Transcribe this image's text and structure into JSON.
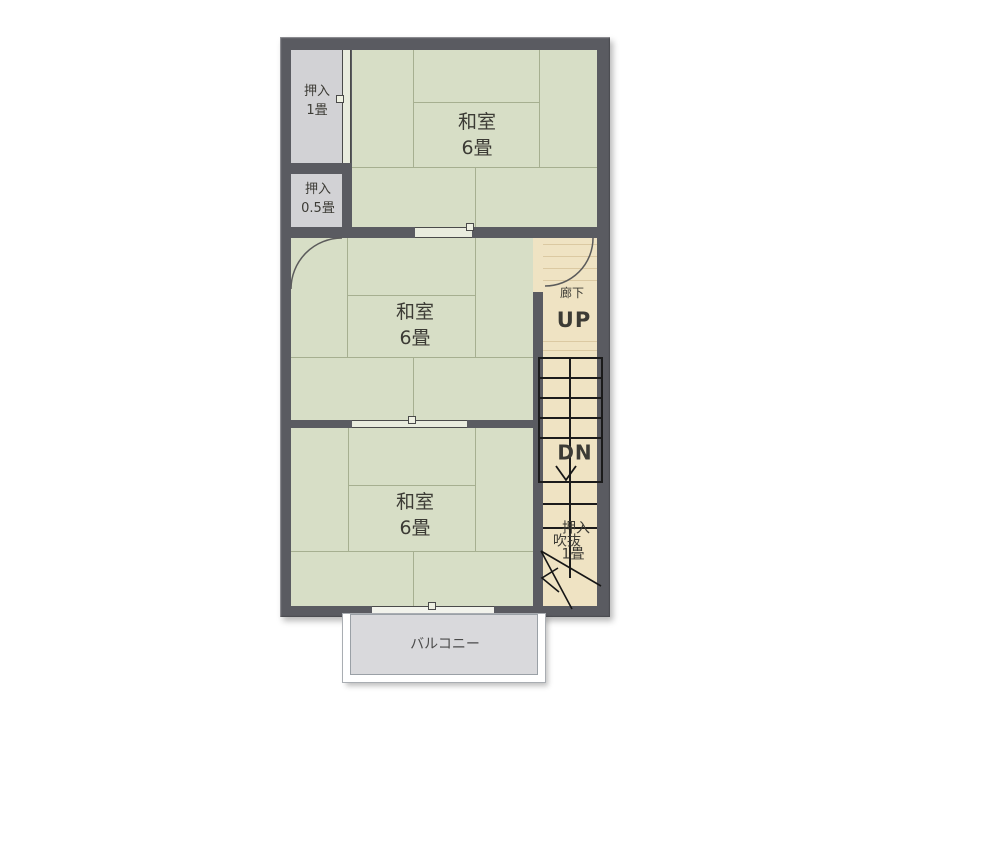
{
  "colors": {
    "wall": "#5a5b61",
    "tatami": "#d7dec6",
    "tatami_line": "#a6af90",
    "closet": "#d2d2d5",
    "hall": "#efe3c3",
    "tread": "#dbc9a2",
    "stair_line": "#1b1b1b",
    "balcony": "#d9d9dc",
    "door_line": "#4a4a4a",
    "text": "#3c3b35"
  },
  "rooms": {
    "washitsu_top": {
      "name": "和室",
      "size": "6畳"
    },
    "washitsu_middle": {
      "name": "和室",
      "size": "6畳"
    },
    "washitsu_bottom": {
      "name": "和室",
      "size": "6畳"
    }
  },
  "closets": {
    "one_jo": {
      "name": "押入",
      "size": "1畳"
    },
    "half_jo": {
      "name": "押入",
      "size": "0.5畳"
    },
    "lower": {
      "line1": "押入",
      "line2": "吹抜",
      "line3": "1畳"
    }
  },
  "hallway": {
    "name": "廊下"
  },
  "stairs": {
    "up_label": "UP",
    "down_label": "DN"
  },
  "balcony": {
    "name": "バルコニー"
  }
}
